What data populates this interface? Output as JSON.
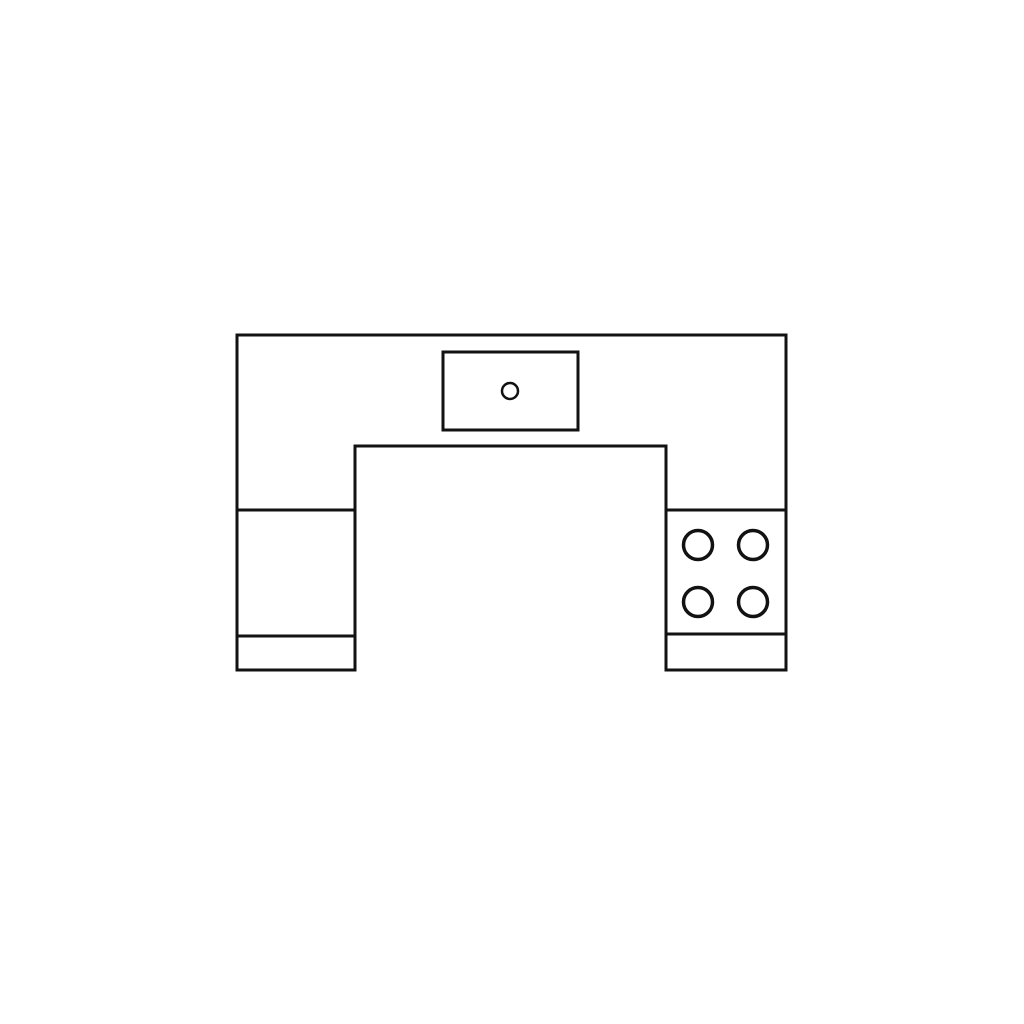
{
  "colors": {
    "background": "#ffffff",
    "stroke": "#121212"
  },
  "diagram": {
    "kind": "u-shaped-kitchen-floor-plan",
    "canvas": {
      "width": 1024,
      "height": 1024
    },
    "counter_outline": {
      "stroke_width": 3,
      "points": [
        [
          237,
          335
        ],
        [
          786,
          335
        ],
        [
          786,
          670
        ],
        [
          666,
          670
        ],
        [
          666,
          446
        ],
        [
          355,
          446
        ],
        [
          355,
          670
        ],
        [
          237,
          670
        ]
      ]
    },
    "section_dividers": [
      {
        "name": "left-leg-counter-top-line",
        "x1": 237,
        "y1": 510,
        "x2": 355,
        "y2": 510
      },
      {
        "name": "right-leg-cooktop-top-line",
        "x1": 666,
        "y1": 510,
        "x2": 786,
        "y2": 510
      },
      {
        "name": "left-leg-counter-bottom-line",
        "x1": 237,
        "y1": 636,
        "x2": 355,
        "y2": 636
      },
      {
        "name": "right-leg-cooktop-bottom-line",
        "x1": 666,
        "y1": 634,
        "x2": 786,
        "y2": 634
      }
    ],
    "divider_stroke_width": 3,
    "sink": {
      "rect": {
        "x": 443,
        "y": 352,
        "width": 135,
        "height": 78,
        "stroke_width": 3
      },
      "drain": {
        "cx": 510,
        "cy": 391,
        "r": 8,
        "stroke_width": 2.5
      }
    },
    "cooktop": {
      "burner_radius": 14.5,
      "burner_stroke_width": 3.5,
      "burner_centers": [
        [
          698,
          545
        ],
        [
          753,
          545
        ],
        [
          698,
          602
        ],
        [
          753,
          602
        ]
      ]
    }
  }
}
